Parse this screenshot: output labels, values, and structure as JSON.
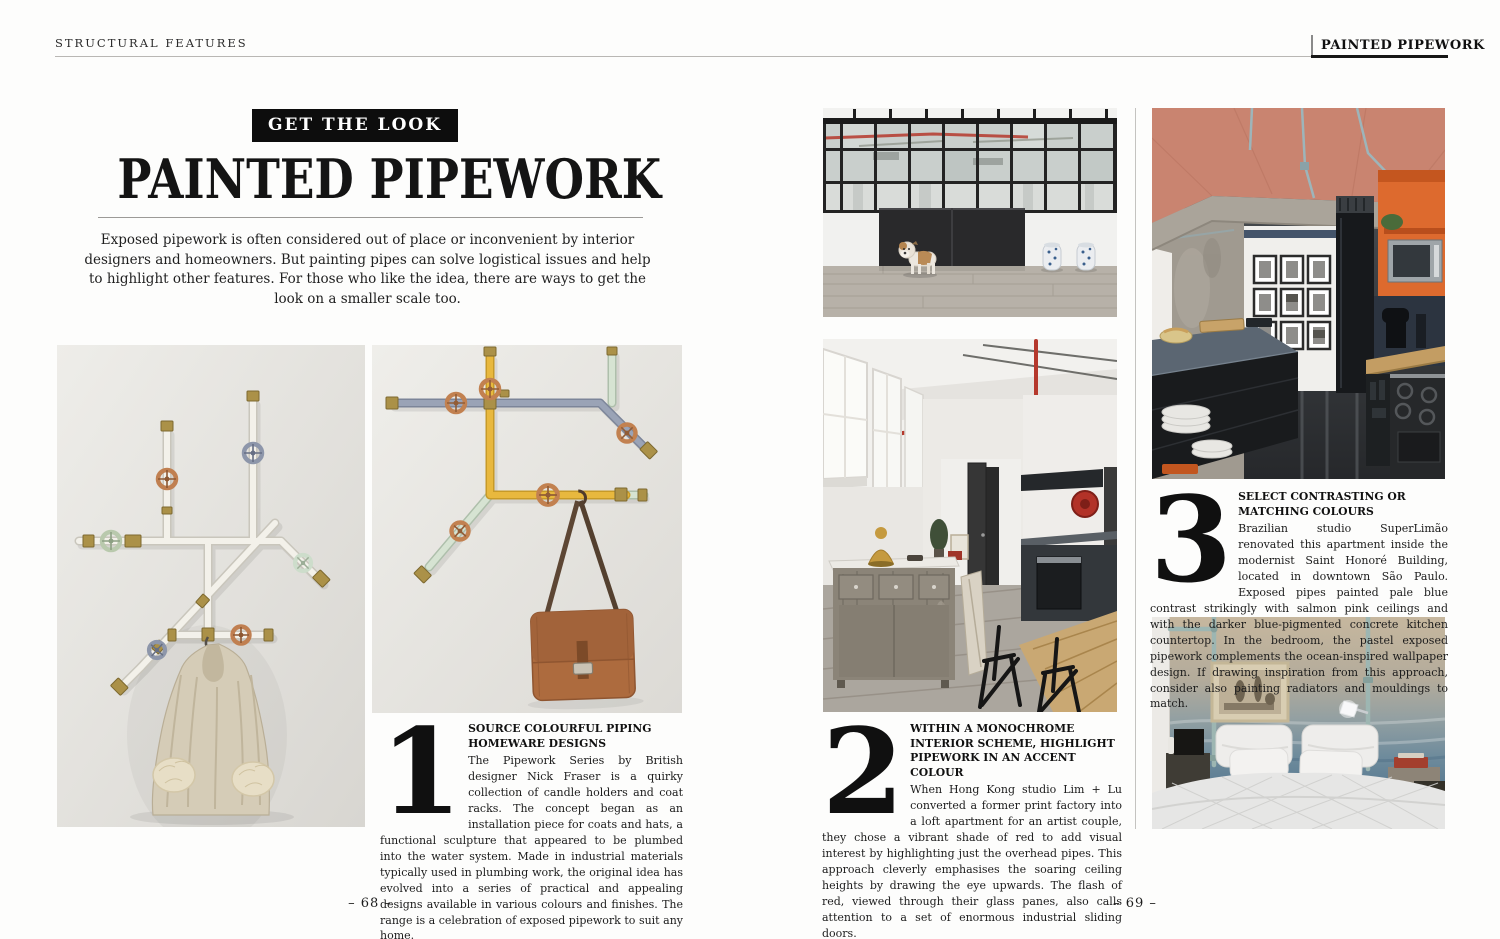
{
  "header": {
    "left": "STRUCTURAL FEATURES",
    "right": "PAINTED PIPEWORK"
  },
  "hero": {
    "badge": "GET THE LOOK",
    "title": "PAINTED PIPEWORK",
    "intro": "Exposed pipework is often considered out of place or inconvenient by interior designers and homeowners. But painting pipes can solve logistical issues and help to highlight other features. For those who like the idea, there are ways to get the look on a smaller scale too."
  },
  "sections": [
    {
      "number": "1",
      "heading": "SOURCE COLOURFUL PIPING HOMEWARE DESIGNS",
      "body": "The Pipework Series by British designer Nick Fraser is a quirky collection of candle holders and coat racks. The concept began as an installation piece for coats and hats, a functional sculpture that appeared to be plumbed into the water system. Made in industrial materials typically used in plumbing work, the original idea has evolved into a series of practical and appealing designs available in various colours and finishes. The range is a celebration of exposed pipework to suit any home."
    },
    {
      "number": "2",
      "heading": "WITHIN A MONOCHROME INTERIOR SCHEME, HIGHLIGHT PIPEWORK IN AN ACCENT COLOUR",
      "body": "When Hong Kong studio Lim + Lu converted a former print factory into a loft apartment for an artist couple, they chose a vibrant shade of red to add visual interest by highlighting just the overhead pipes. This approach cleverly emphasises the soaring ceiling heights by drawing the eye upwards. The flash of red, viewed through their glass panes, also calls attention to a set of enormous industrial sliding doors."
    },
    {
      "number": "3",
      "heading": "SELECT CONTRASTING OR MATCHING COLOURS",
      "body": "Brazilian studio SuperLimão renovated this apartment inside the modernist Saint Honoré Building, located in downtown São Paulo. Exposed pipes painted pale blue contrast strikingly with salmon pink ceilings and with the darker blue-pigmented concrete kitchen countertop. In the bedroom, the pastel exposed pipework complements the ocean-inspired wallpaper design. If drawing inspiration from this approach, consider also painting radiators and mouldings to match."
    }
  ],
  "footer": {
    "left_page": "– 68 –",
    "right_page": "– 69 –"
  },
  "colors": {
    "badge_black": "#0d0d0d",
    "accent_red_pipe": "#b5382c",
    "salmon_ceiling": "#c98470",
    "pale_blue_pipe": "#9db5ba",
    "yellow_pipe": "#e8b83e",
    "leather_brown": "#ad6b3e"
  }
}
